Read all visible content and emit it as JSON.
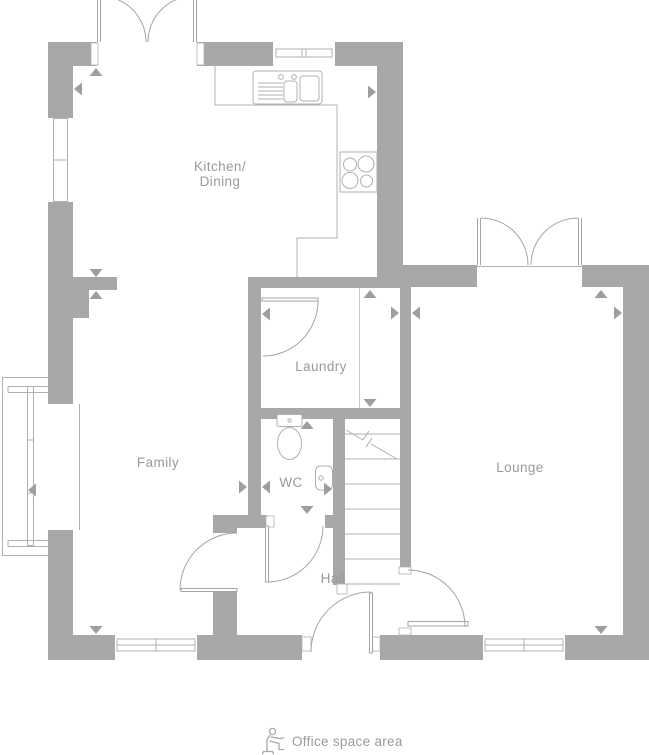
{
  "rooms": {
    "kitchen_dining": {
      "line1": "Kitchen/",
      "line2": "Dining"
    },
    "family": {
      "label": "Family"
    },
    "laundry": {
      "label": "Laundry"
    },
    "wc": {
      "label": "WC"
    },
    "lounge": {
      "label": "Lounge"
    },
    "hall": {
      "label": "Hall"
    }
  },
  "legend": {
    "icon": "person-at-desk-icon",
    "label": "Office space area"
  },
  "colors": {
    "wall": "#a8a8a8",
    "fixture_line": "#b0b0b0",
    "door_arc": "#a5a5a5",
    "label_text": "#9a9a9a",
    "dimension_arrow": "#9e9e9e",
    "background": "#ffffff"
  }
}
